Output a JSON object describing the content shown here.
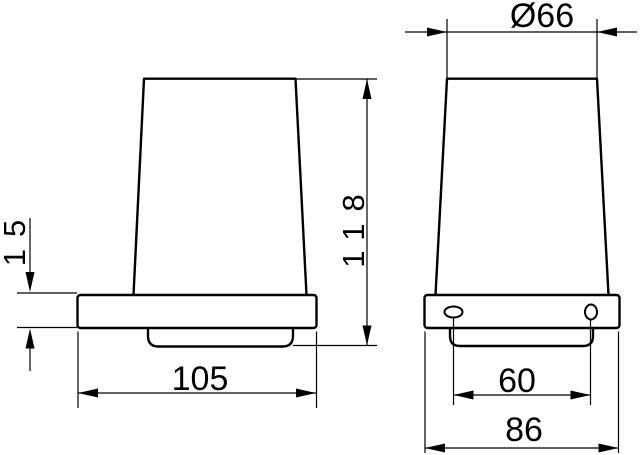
{
  "drawing": {
    "title": "tumbler-holder-dimension-drawing",
    "colors": {
      "line": "#000000",
      "background": "#ffffff"
    },
    "dimensions": {
      "diameter": "Ø66",
      "height": "118",
      "plate_thickness": "15",
      "depth": "105",
      "hole_spacing": "60",
      "width": "86"
    }
  }
}
